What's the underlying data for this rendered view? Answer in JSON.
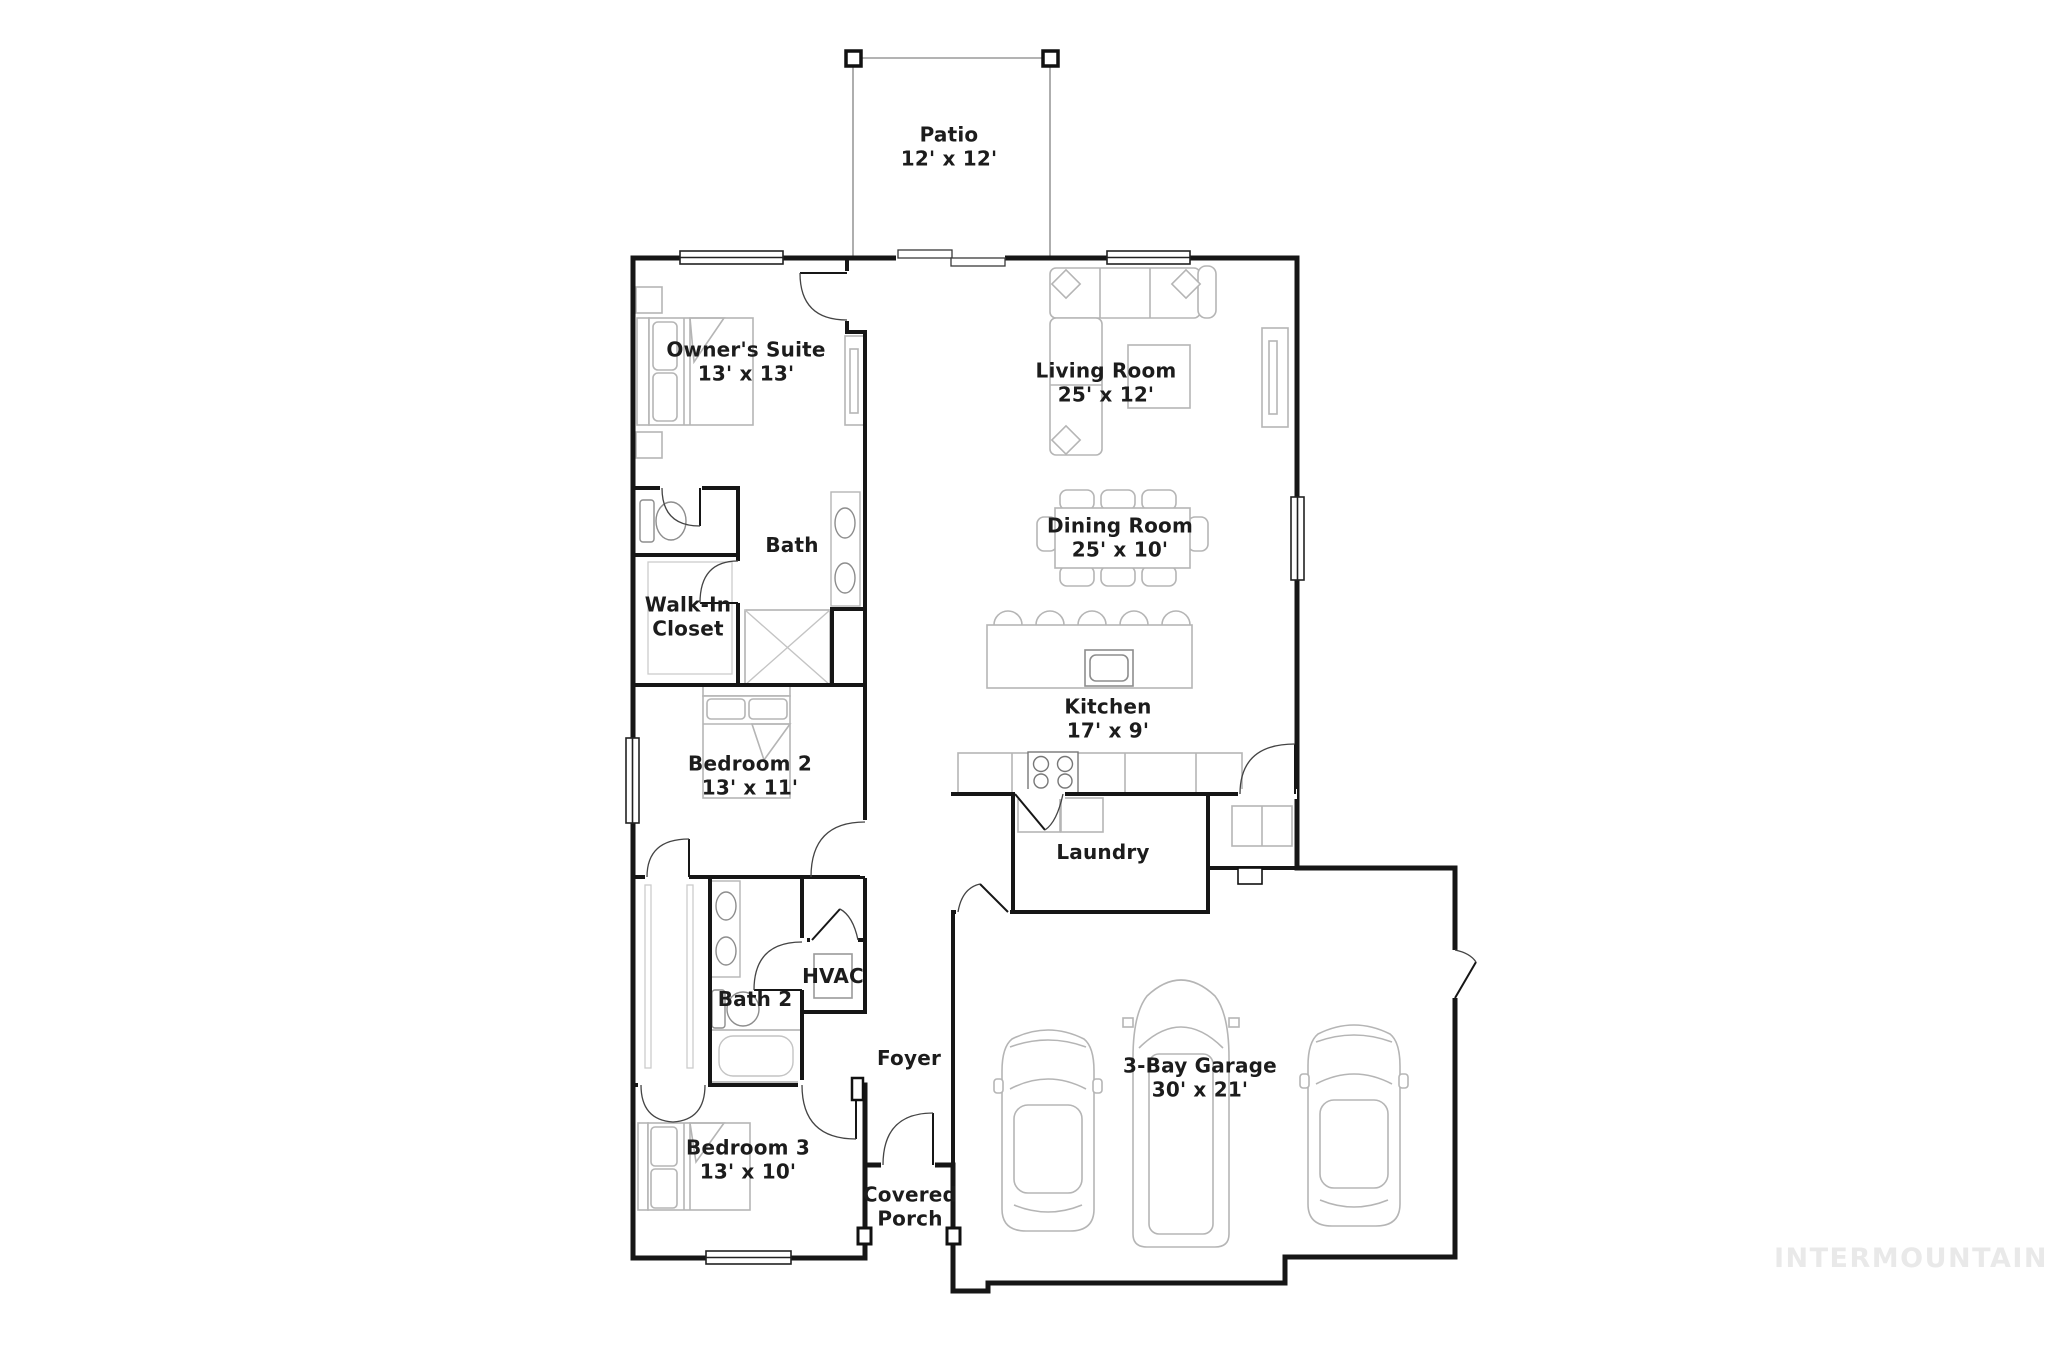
{
  "watermark": "INTERMOUNTAIN",
  "colors": {
    "wall": "#161616",
    "furniture": "#b5b5b5",
    "patio_outline": "#9a9a9a",
    "watermark": "#e9e9e9",
    "label_text": "#1c1c1c"
  },
  "rooms": {
    "patio": {
      "name": "Patio",
      "dims": "12' x 12'"
    },
    "owners_suite": {
      "name": "Owner's Suite",
      "dims": "13' x 13'"
    },
    "living_room": {
      "name": "Living Room",
      "dims": "25' x 12'"
    },
    "dining_room": {
      "name": "Dining Room",
      "dims": "25' x 10'"
    },
    "bath": {
      "name": "Bath",
      "dims": ""
    },
    "walk_in_closet": {
      "name": "Walk-In Closet",
      "dims": ""
    },
    "kitchen": {
      "name": "Kitchen",
      "dims": "17' x 9'"
    },
    "bedroom2": {
      "name": "Bedroom 2",
      "dims": "13' x 11'"
    },
    "laundry": {
      "name": "Laundry",
      "dims": ""
    },
    "hvac": {
      "name": "HVAC",
      "dims": ""
    },
    "bath2": {
      "name": "Bath 2",
      "dims": ""
    },
    "foyer": {
      "name": "Foyer",
      "dims": ""
    },
    "garage": {
      "name": "3-Bay Garage",
      "dims": "30' x 21'"
    },
    "bedroom3": {
      "name": "Bedroom 3",
      "dims": "13' x 10'"
    },
    "covered_porch": {
      "name": "Covered Porch",
      "dims": ""
    }
  }
}
